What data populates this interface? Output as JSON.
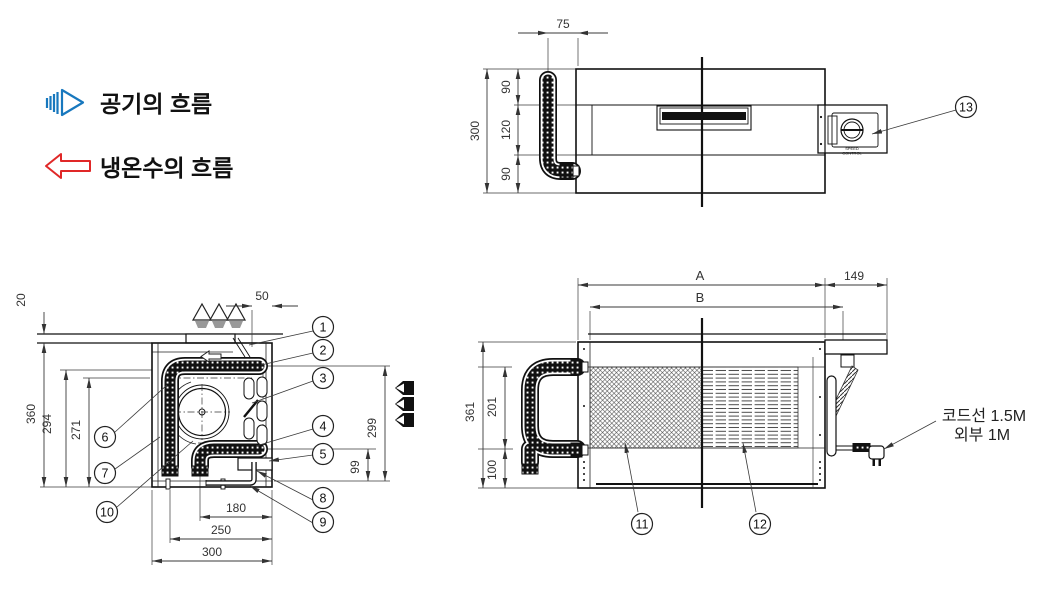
{
  "legend": {
    "air_label": "공기의 흐름",
    "water_label": "냉온수의 흐름",
    "air_color": "#1878be",
    "water_color": "#e02828"
  },
  "plan_view": {
    "dims": {
      "pipe_offset": "75",
      "seg_top": "90",
      "seg_mid": "120",
      "seg_bottom": "90",
      "height": "300"
    },
    "speed_control": {
      "line1": "SPEED",
      "line2": "CONTROL"
    },
    "callouts": {
      "c13": "13"
    }
  },
  "side_view": {
    "dims": {
      "ceiling": "20",
      "outlet": "50",
      "height": "360",
      "coil_top": "294",
      "coil_mid": "271",
      "right": "299",
      "drain": "99",
      "w_inner": "180",
      "w_mid": "250",
      "w_outer": "300"
    },
    "callouts": {
      "c1": "1",
      "c2": "2",
      "c3": "3",
      "c4": "4",
      "c5": "5",
      "c6": "6",
      "c7": "7",
      "c8": "8",
      "c9": "9",
      "c10": "10"
    }
  },
  "front_view": {
    "dims": {
      "a": "A",
      "b": "B",
      "bracket": "149",
      "height": "361",
      "pipe_span": "201",
      "bottom": "100"
    },
    "callouts": {
      "c11": "11",
      "c12": "12"
    },
    "note": {
      "line1": "코드선 1.5M",
      "line2": "외부 1M"
    }
  }
}
